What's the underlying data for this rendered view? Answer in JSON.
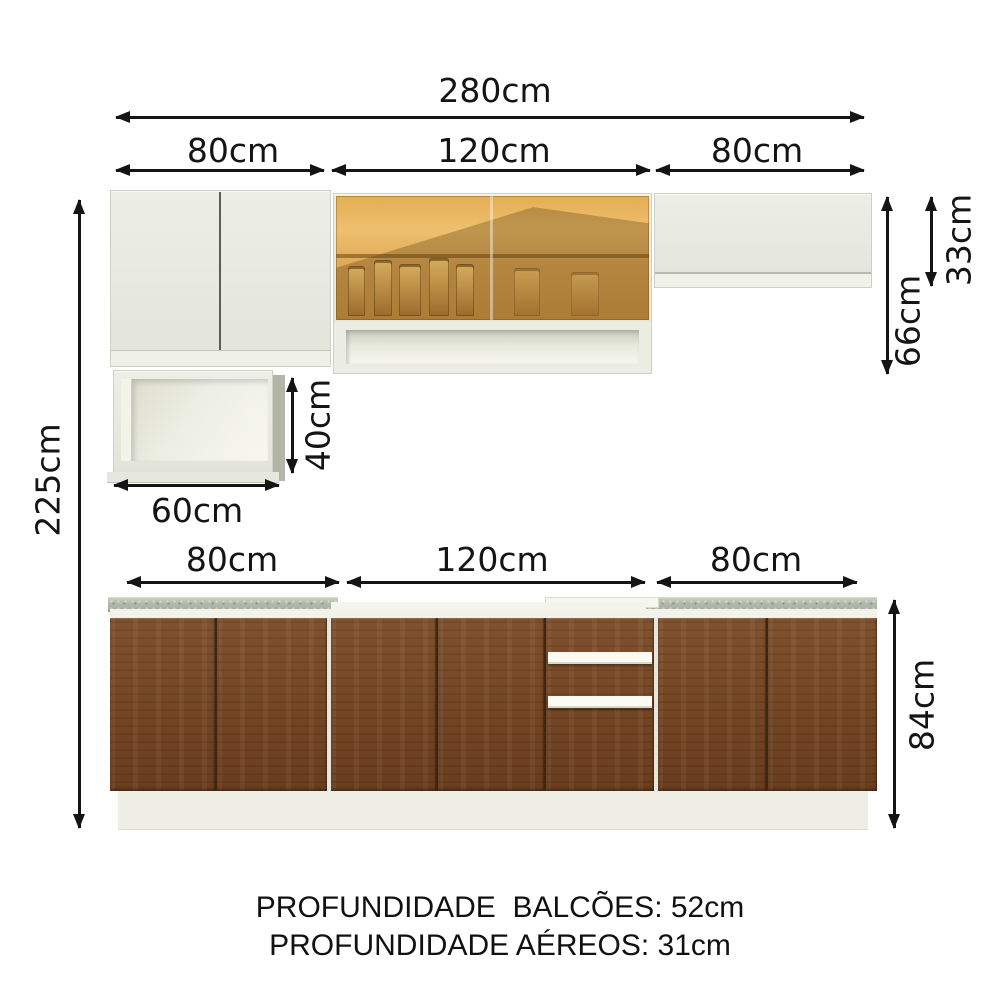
{
  "dims": {
    "total_width": "280cm",
    "total_height": "225cm",
    "upper_sections": [
      "80cm",
      "120cm",
      "80cm"
    ],
    "lower_sections": [
      "80cm",
      "120cm",
      "80cm"
    ],
    "upper_cabinet_height": "66cm",
    "upper_short_cabinet_height": "33cm",
    "niche_width": "60cm",
    "niche_height": "40cm",
    "base_cabinet_height": "84cm"
  },
  "footer": {
    "line1": "PROFUNDIDADE  BALCÕES: 52cm",
    "line2": "PROFUNDIDADE AÉREOS: 31cm"
  },
  "colors": {
    "background": "#ffffff",
    "cabinet_white": "#e9eae1",
    "wood_brown": "#764928",
    "countertop_gray_green": "#b4bdac",
    "glass_amber": "#e0ab58",
    "annotation_black": "#141414"
  }
}
